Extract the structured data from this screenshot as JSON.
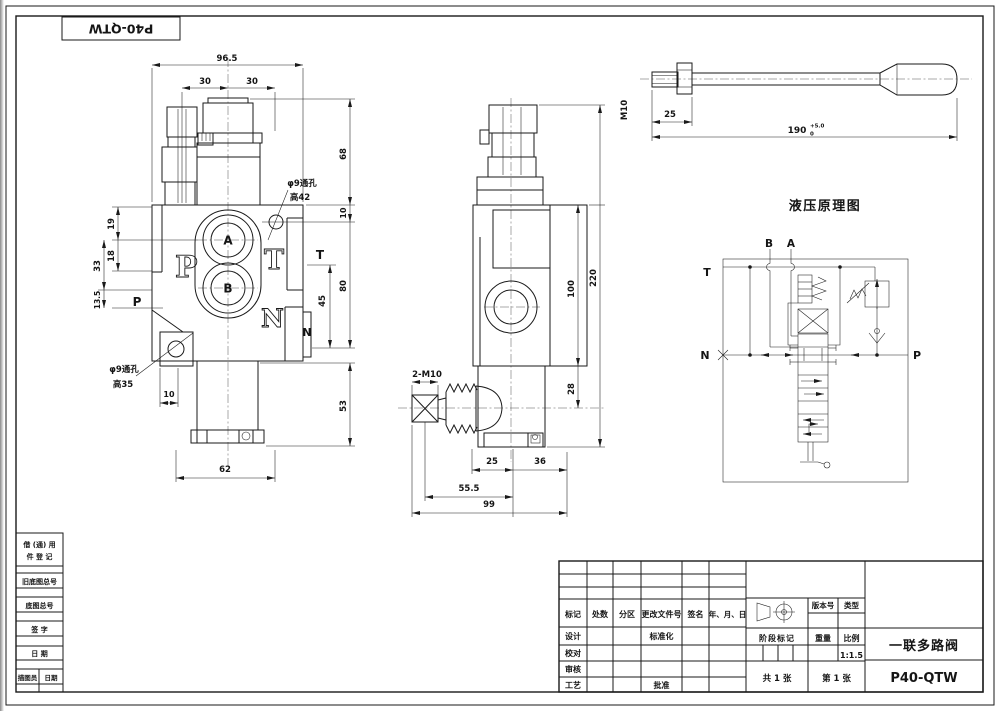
{
  "corner": {
    "part_no": "P40-QTW"
  },
  "front": {
    "d96_5": "96.5",
    "d30l": "30",
    "d30r": "30",
    "d68": "68",
    "d10_hole": "10",
    "d80": "80",
    "d45": "45",
    "d53": "53",
    "d19": "19",
    "d18": "18",
    "d33": "33",
    "d13_5": "13.5",
    "d10_foot": "10",
    "d62": "62",
    "port_a": "A",
    "port_b": "B",
    "p_big": "P",
    "t_big": "T",
    "n_big": "N",
    "p_small": "P",
    "t_small": "T",
    "n_small": "N",
    "hole42_l1": "φ9通孔",
    "hole42_l2": "高42",
    "hole35_l1": "φ9通孔",
    "hole35_l2": "高35"
  },
  "side": {
    "d220": "220",
    "d100": "100",
    "d28": "28",
    "d25": "25",
    "d36": "36",
    "d55_5": "55.5",
    "d99": "99",
    "stud": "2-M10"
  },
  "handle": {
    "thread": "M10",
    "d25": "25",
    "d190": "190",
    "tol_up": "+5.0",
    "tol_dn": "0"
  },
  "schematic": {
    "title": "液压原理图",
    "b": "B",
    "a": "A",
    "t": "T",
    "n": "N",
    "p": "P"
  },
  "margin": {
    "borrow1": "借 (通) 用",
    "borrow2": "件 登 记",
    "old_base": "旧底图总号",
    "base": "底图总号",
    "sign": "签 字",
    "date": "日 期",
    "tracer": "描图员",
    "trace_date": "日期"
  },
  "tb": {
    "mark": "标记",
    "count": "处数",
    "zone": "分区",
    "doc_no": "更改文件号",
    "signature": "签名",
    "ymd": "年、月、日",
    "design": "设计",
    "proof": "校对",
    "audit": "审核",
    "process": "工艺",
    "standard": "标准化",
    "approve": "批准",
    "version": "版本号",
    "type": "类型",
    "stage": "阶段标记",
    "weight": "重量",
    "scale": "比例",
    "scale_v": "1:1.5",
    "total": "共 1 张",
    "sheet": "第 1 张",
    "name": "一联多路阀",
    "model": "P40-QTW"
  }
}
